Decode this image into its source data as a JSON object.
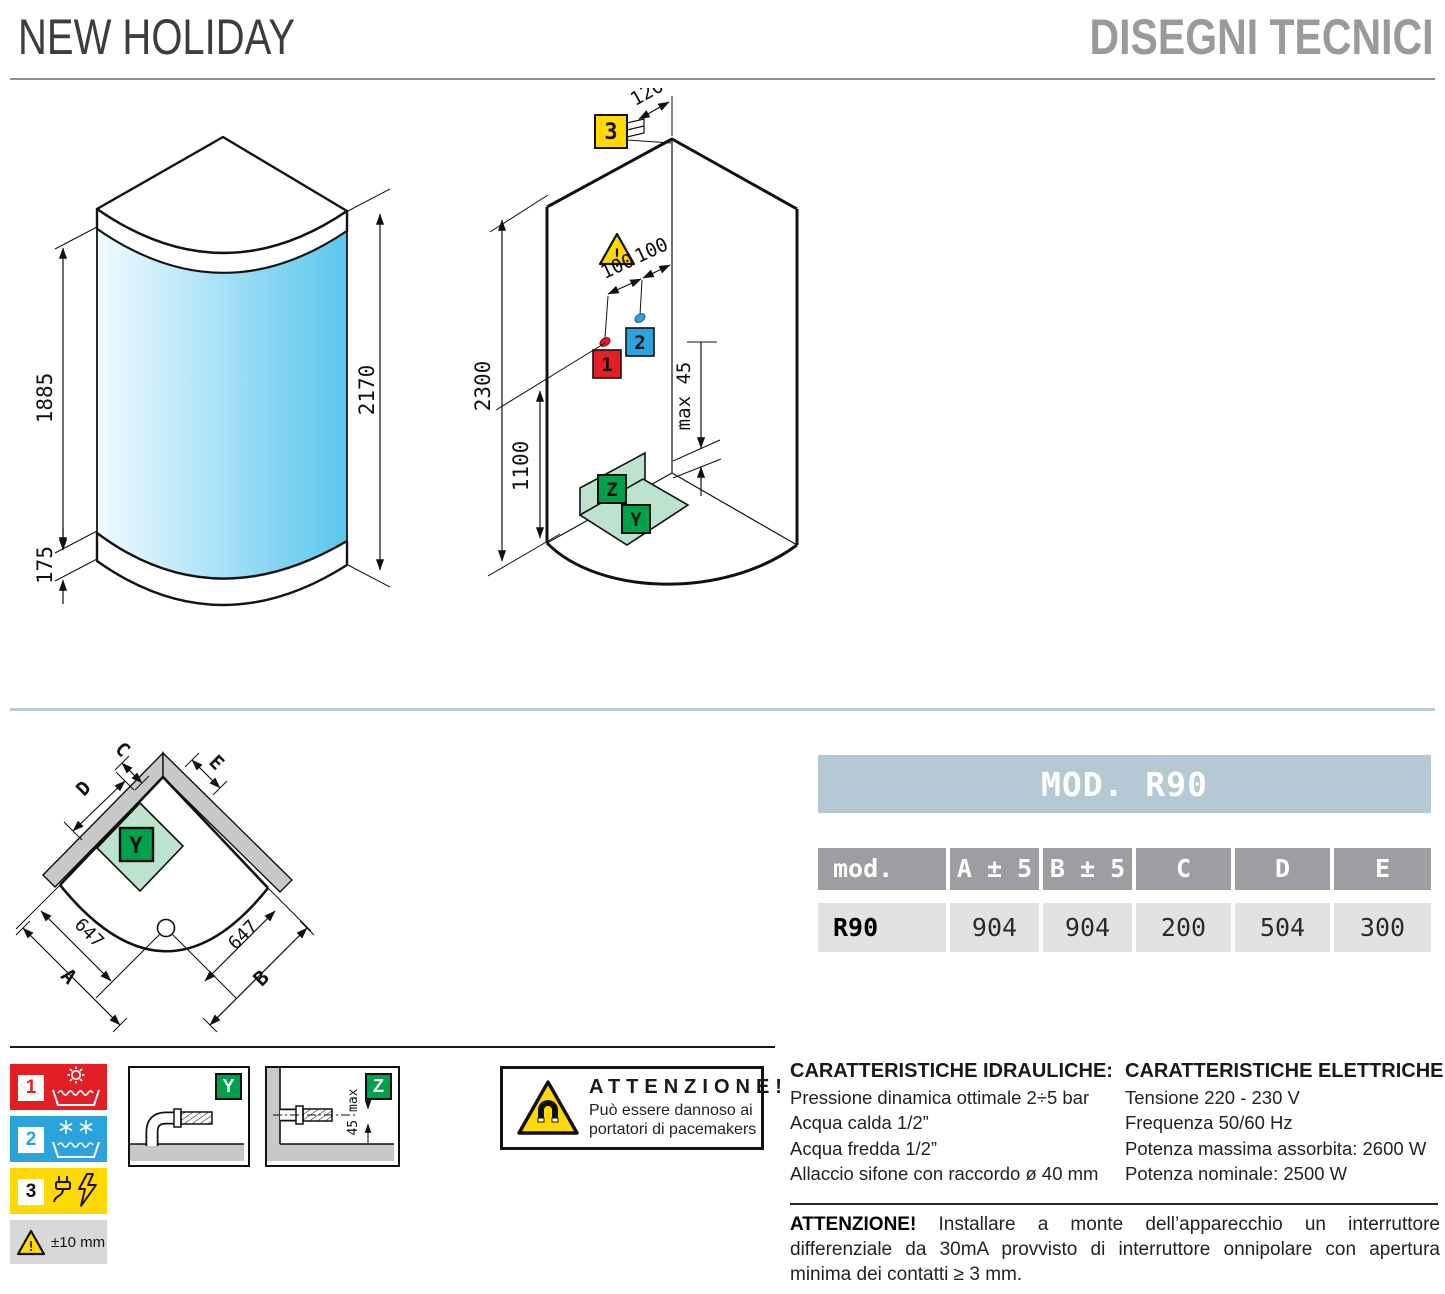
{
  "header": {
    "title": "NEW HOLIDAY",
    "subtitle": "DISEGNI TECNICI"
  },
  "front_view": {
    "glass_height": "1885",
    "tray_height": "175",
    "total_height": "2170"
  },
  "install_view": {
    "top_offset": "120",
    "electric_point": "3",
    "warning_mark": "!",
    "hot_dim": "100",
    "cold_dim": "100",
    "hot_point": "1",
    "cold_point": "2",
    "total_height": "2300",
    "mixer_height": "1100",
    "drain_note": "max 45",
    "wall_drain": "Z",
    "floor_drain": "Y"
  },
  "plan_view": {
    "dim_a": "A",
    "dim_b": "B",
    "dim_c": "C",
    "dim_d": "D",
    "dim_e": "E",
    "left_647": "647",
    "right_647": "647",
    "area": "Y"
  },
  "table": {
    "title": "MOD. R90",
    "col_mod": "mod.",
    "col_a": "A ± 5",
    "col_b": "B ± 5",
    "col_c": "C",
    "col_d": "D",
    "col_e": "E",
    "row_model": "R90",
    "val_a": "904",
    "val_b": "904",
    "val_c": "200",
    "val_d": "504",
    "val_e": "300"
  },
  "legend": {
    "hot": "1",
    "cold": "2",
    "electric": "3",
    "tolerance": "±10 mm",
    "warning_mark": "!"
  },
  "detail_y": {
    "label": "Y"
  },
  "detail_z": {
    "label": "Z",
    "dim": "45 max"
  },
  "magnet_warning": {
    "title": "ATTENZIONE!",
    "line1": "Può essere dannoso ai",
    "line2": "portatori di pacemakers"
  },
  "hydraulics": {
    "title": "CARATTERISTICHE IDRAULICHE:",
    "lines": [
      "Pressione dinamica ottimale 2÷5 bar",
      "Acqua calda 1/2”",
      "Acqua fredda 1/2”",
      "Allaccio sifone con raccordo ø 40 mm"
    ]
  },
  "electrics": {
    "title": "CARATTERISTICHE ELETTRICHE:",
    "lines": [
      "Tensione 220 - 230 V",
      "Frequenza 50/60 Hz",
      "Potenza massima assorbita: 2600 W",
      "Potenza nominale: 2500 W"
    ]
  },
  "note": {
    "title": "ATTENZIONE!",
    "text": "Installare a monte dell’apparecchio un interruttore differenziale da 30mA provvisto di interruttore onnipolare con apertura minima dei contatti ≥ 3 mm."
  },
  "colors": {
    "band_blue": "#b5c9d4",
    "header_gray": "#9c9ea1",
    "cell_gray": "#e1e2e3",
    "red": "#e31e24",
    "blue": "#2ba3dc",
    "yellow": "#ffd900",
    "green": "#00a14b",
    "light_green": "#bce3cd",
    "glass_from": "#f2fbff",
    "glass_to": "#5ac6ee"
  }
}
